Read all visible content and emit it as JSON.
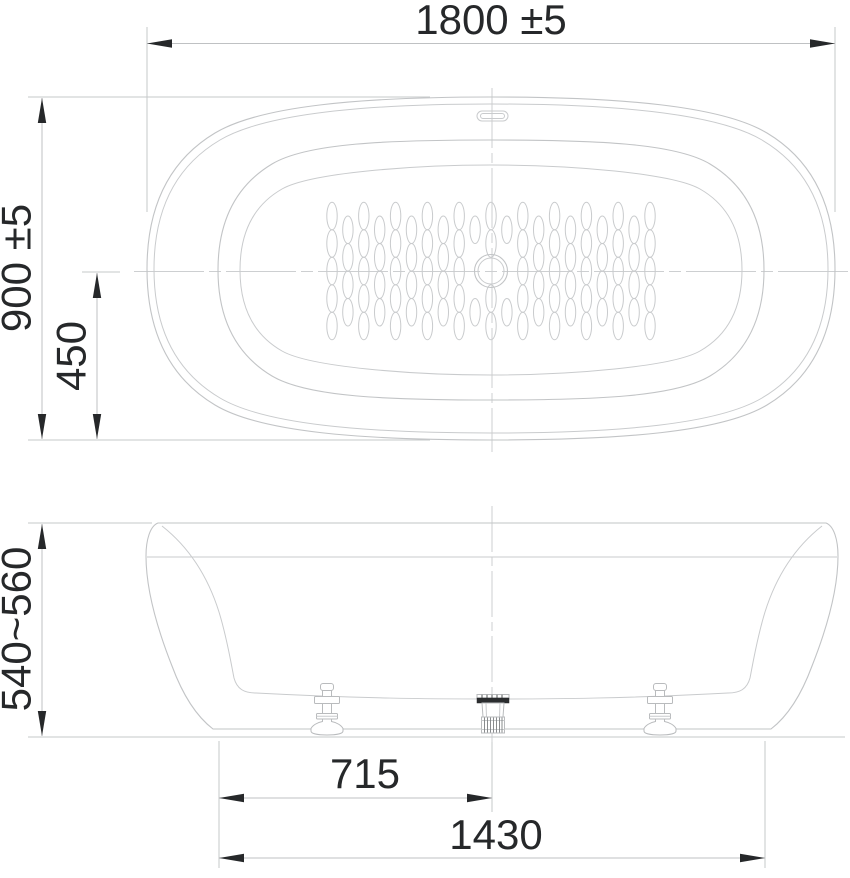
{
  "drawing": {
    "subject": "oval freestanding bathtub technical dimension drawing",
    "views": {
      "top_view": "top view",
      "front_view": "front elevation"
    }
  },
  "dimensions": {
    "overall_width": "1800 ±5",
    "overall_depth": "900 ±5",
    "center_to_edge": "450",
    "height": "540~560",
    "drain_to_base_edge": "715",
    "base_length": "1430"
  },
  "components": {
    "drain_icon": "center waste drain",
    "overflow_icon": "overflow slot",
    "foot_icon": "adjustable leveling foot",
    "antislip_icon": "anti-slip dot pattern"
  },
  "colors": {
    "background": "#ffffff",
    "outline": "#c2c4c6",
    "centerline": "#cdcfd1",
    "dimension_line": "#bfc1c3",
    "ink": "#26282a",
    "drain_flange": "#2b2d2f"
  },
  "top_view": {
    "antislip_pattern": {
      "columns": 21,
      "column_pitch": 15.9,
      "row_pitch": 27.5,
      "dot_rx": 5.2,
      "dot_ry": 13.8,
      "center_x": 491,
      "center_y": 271,
      "clear_radius": 22
    }
  }
}
